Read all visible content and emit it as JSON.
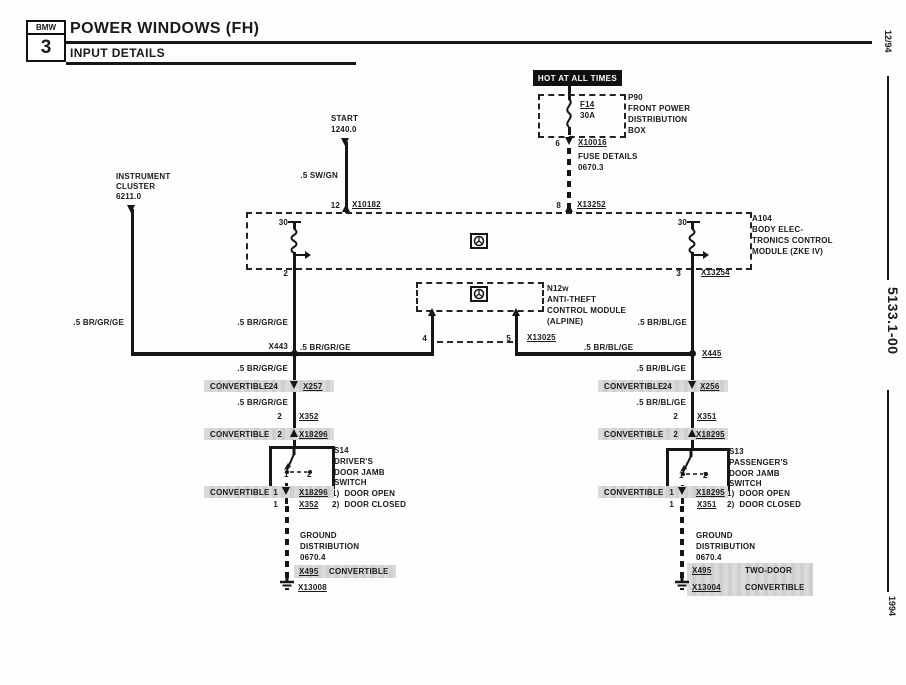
{
  "header": {
    "logo_top": "BMW",
    "logo_number": "3",
    "title": "POWER WINDOWS (FH)",
    "subtitle": "INPUT DETAILS"
  },
  "margin": {
    "issue": "12/94",
    "sheet": "5133.1-00",
    "year": "1994"
  },
  "supply": {
    "hot": "HOT AT ALL TIMES",
    "fuse": "F14",
    "rating": "30A",
    "box_id": "P90",
    "box_l1": "FRONT POWER",
    "box_l2": "DISTRIBUTION",
    "box_l3": "BOX",
    "pin_a": "6",
    "conn_a": "X10016",
    "detail_l1": "FUSE DETAILS",
    "detail_l2": "0670.3",
    "pin_b": "8",
    "conn_b": "X13252"
  },
  "start": {
    "l1": "START",
    "l2": "1240.0",
    "wire": ".5 SW/GN",
    "pin": "12",
    "conn": "X10182"
  },
  "cluster": {
    "l1": "INSTRUMENT",
    "l2": "CLUSTER",
    "l3": "6211.0",
    "wire": ".5 BR/GR/GE"
  },
  "a104": {
    "id": "A104",
    "l1": "BODY ELEC-",
    "l2": "TRONICS CONTROL",
    "l3": "MODULE (ZKE IV)",
    "pin30_l": "30",
    "pin30_r": "30",
    "pin2": "2",
    "pin3": "3",
    "conn3": "X13254"
  },
  "n12w": {
    "id": "N12w",
    "l1": "ANTI-THEFT",
    "l2": "CONTROL MODULE",
    "l3": "(ALPINE)",
    "pin4": "4",
    "pin5": "5",
    "conn": "X13025"
  },
  "left": {
    "wire_top": ".5 BR/GR/GE",
    "junction": "X443",
    "bus_wire": ".5 BR/GR/GE",
    "wire1": ".5 BR/GR/GE",
    "conv1": {
      "note": "CONVERTIBLE",
      "pin": "24",
      "conn": "X257"
    },
    "wire2": ".5 BR/GR/GE",
    "pin_top": "2",
    "conn_top": "X352",
    "conv2": {
      "note": "CONVERTIBLE",
      "pin": "2",
      "conn": "X18296"
    },
    "switch": {
      "id": "S14",
      "l1": "DRIVER'S",
      "l2": "DOOR JAMB",
      "l3": "SWITCH",
      "pin1": "1",
      "pin2": "2",
      "legend1": "1)  DOOR OPEN",
      "legend2": "2)  DOOR CLOSED"
    },
    "conv3": {
      "note": "CONVERTIBLE",
      "pin": "1",
      "conn": "X18296"
    },
    "pin_bot": "1",
    "conn_bot": "X352",
    "gnd_l1": "GROUND",
    "gnd_l2": "DISTRIBUTION",
    "gnd_l3": "0670.4",
    "gnd_row": {
      "conn": "X495",
      "note": "CONVERTIBLE"
    },
    "gnd_conn": "X13008"
  },
  "right": {
    "wire_top": ".5 BR/BL/GE",
    "junction": "X445",
    "bus_wire": ".5 BR/BL/GE",
    "wire1": ".5 BR/BL/GE",
    "conv1": {
      "note": "CONVERTIBLE",
      "pin": "24",
      "conn": "X256"
    },
    "wire2": ".5 BR/BL/GE",
    "pin_top": "2",
    "conn_top": "X351",
    "conv2": {
      "note": "CONVERTIBLE",
      "pin": "2",
      "conn": "X18295"
    },
    "switch": {
      "id": "S13",
      "l1": "PASSENGER'S",
      "l2": "DOOR JAMB",
      "l3": "SWITCH",
      "pin1": "1",
      "pin2": "2",
      "legend1": "1)  DOOR OPEN",
      "legend2": "2)  DOOR CLOSED"
    },
    "conv3": {
      "note": "CONVERTIBLE",
      "pin": "1",
      "conn": "X18295"
    },
    "pin_bot": "1",
    "conn_bot": "X351",
    "gnd_l1": "GROUND",
    "gnd_l2": "DISTRIBUTION",
    "gnd_l3": "0670.4",
    "gnd_row": {
      "conn1": "X495",
      "note1": "TWO-DOOR",
      "conn2": "X13004",
      "note2": "CONVERTIBLE"
    }
  }
}
